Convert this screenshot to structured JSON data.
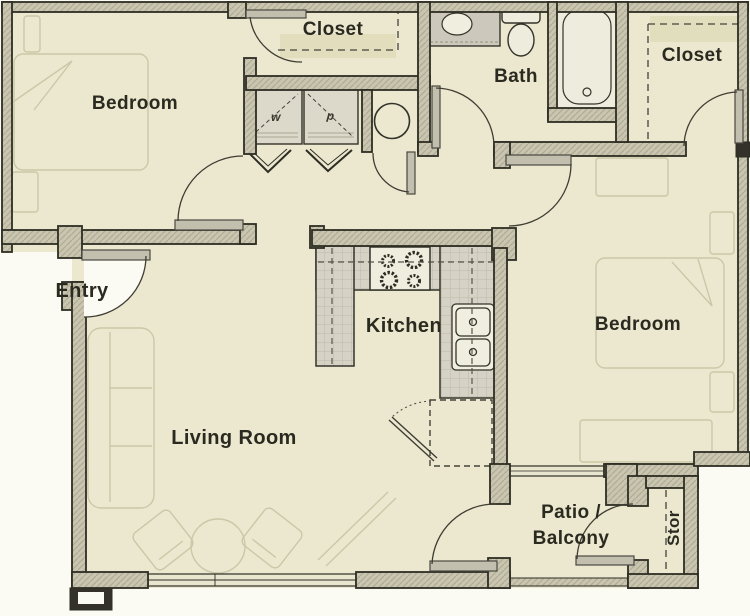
{
  "labels": {
    "bedroom_left": "Bedroom",
    "closet_top": "Closet",
    "bath": "Bath",
    "closet_right": "Closet",
    "entry": "Entry",
    "kitchen": "Kitchen",
    "bedroom_right": "Bedroom",
    "living_room": "Living Room",
    "patio_line1": "Patio /",
    "patio_line2": "Balcony",
    "storage": "Stor",
    "washer": "w",
    "dryer": "d"
  },
  "colors": {
    "floor": "#ebe8cf",
    "exterior": "#fbfaf3",
    "wall_fill": "#c9c5b0",
    "wall_line": "#2e2d23",
    "counter": "#d6d3c6",
    "fixture_white": "#f0eede",
    "faint_furniture": "#cbc7a8",
    "text": "#2b2a20"
  },
  "fixtures": {
    "laundry": [
      "washer-icon",
      "dryer-icon",
      "water-heater-icon"
    ],
    "bath": [
      "sink-icon",
      "toilet-icon",
      "bathtub-icon"
    ],
    "kitchen": [
      "range-burners-icon",
      "double-sink-icon",
      "refrigerator-icon"
    ]
  }
}
